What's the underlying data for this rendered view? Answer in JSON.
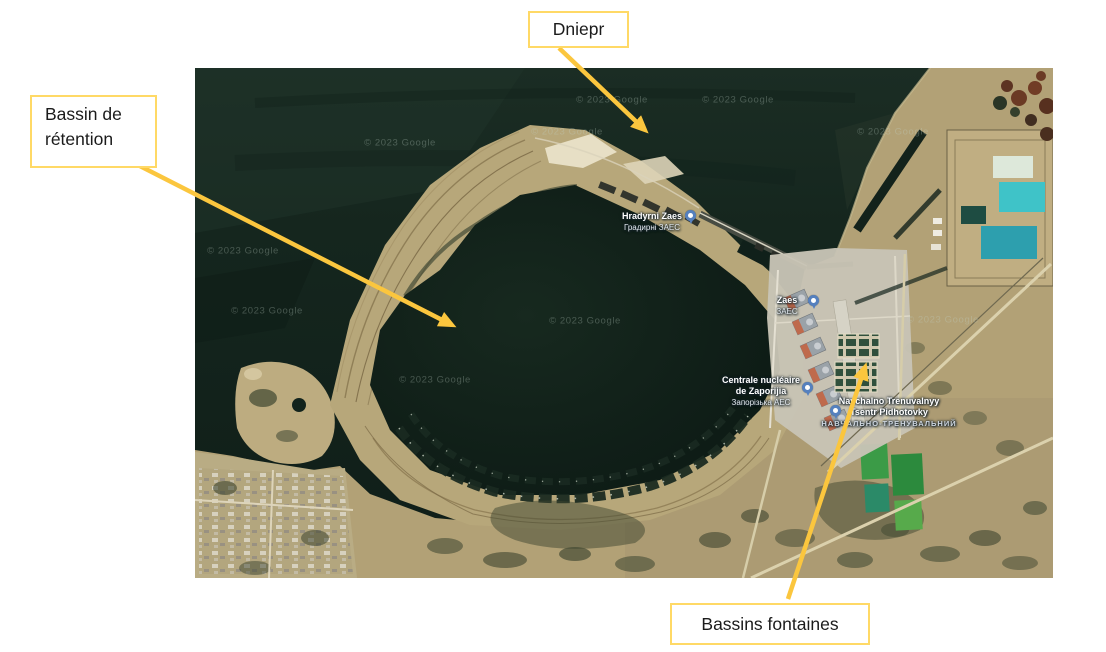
{
  "slide": {
    "background": "#ffffff"
  },
  "annotations": {
    "arrow_color": "#FBC63E",
    "box_border_color": "#FFD966",
    "dniepr": "Dniepr",
    "bassin_line1": "Bassin de",
    "bassin_line2": "rétention",
    "fontaines": "Bassins fontaines"
  },
  "map": {
    "watermark": "© 2023 Google",
    "pin_color": "#5580BE",
    "labels": {
      "cooling_towers": {
        "latin": "Hradyrni Zaes",
        "cyrillic": "Градирні ЗАЕС"
      },
      "zaes": {
        "latin": "Zaes",
        "cyrillic": "ЗАЕС"
      },
      "plant": {
        "line1": "Centrale nucléaire",
        "line2": "de Zaporijia",
        "cyrillic": "Запорізька АЕС"
      },
      "training_center": {
        "line1": "Navchalno Trenuvalnyy",
        "line2": "Tsentr Pidhotovky",
        "cyrillic": "НАВЧАЛЬНО-ТРЕНУВАЛЬНИЙ"
      }
    }
  }
}
